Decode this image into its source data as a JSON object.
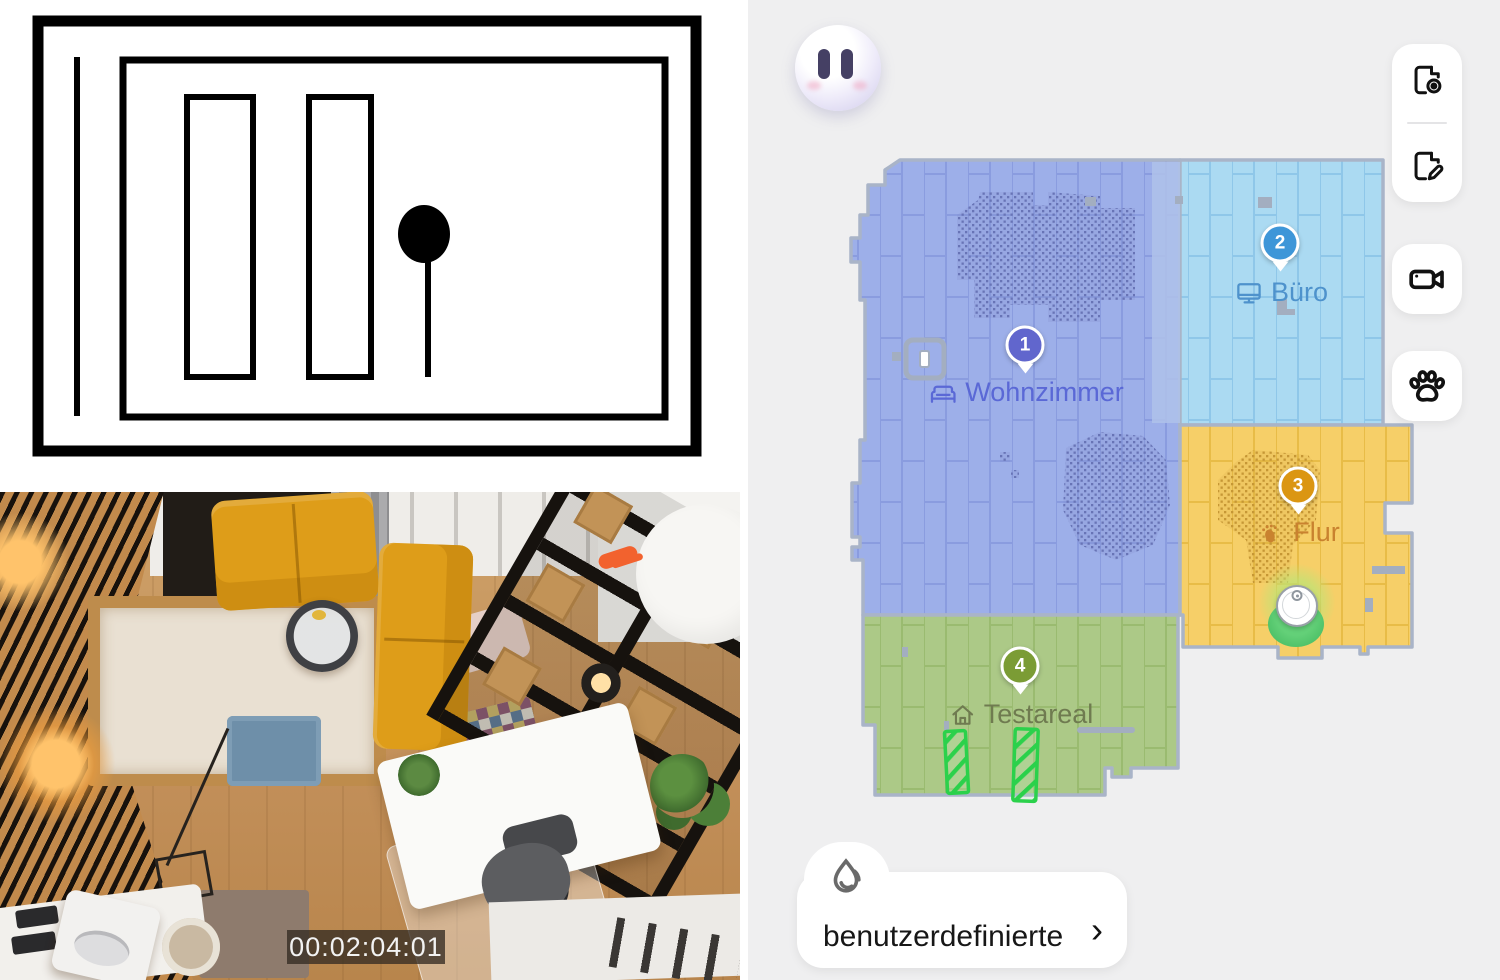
{
  "app": {
    "avatar": {
      "name": "robot-avatar",
      "state": "paused-eyes"
    },
    "toolbar": {
      "buttons": [
        {
          "name": "map-view-toggle",
          "icon": "map-eye-icon"
        },
        {
          "name": "map-edit",
          "icon": "map-edit-icon"
        },
        {
          "name": "video-camera",
          "icon": "camera-icon"
        },
        {
          "name": "pet-mode",
          "icon": "paw-icon"
        }
      ]
    },
    "map": {
      "wall_color": "#A9B4C8",
      "background": "#EFEFF0",
      "rooms": [
        {
          "number": "1",
          "name": "Wohnzimmer",
          "icon": "sofa-icon",
          "fill": "#9DAFE9",
          "marker_color": "#6166CD",
          "label_color": "#5A68D6"
        },
        {
          "number": "2",
          "name": "Büro",
          "icon": "monitor-icon",
          "fill": "#ABDAF2",
          "marker_color": "#3E96D8",
          "label_color": "#4E92CC"
        },
        {
          "number": "3",
          "name": "Flur",
          "icon": "footprints-icon",
          "fill": "#F6CF68",
          "marker_color": "#DB9612",
          "label_color": "#C9822F"
        },
        {
          "number": "4",
          "name": "Testareal",
          "icon": "house-icon",
          "fill": "#ACC987",
          "marker_color": "#7B9C35",
          "label_color": "#6F7B50"
        }
      ],
      "no_go_zone_color": "#2BD14B",
      "robot": {
        "name": "robot-position",
        "on_dock": true
      }
    },
    "bottom_card": {
      "label": "benutzerdefinierte",
      "chevron_glyph": "›",
      "icon": "water-drop-icon"
    }
  },
  "camera_view": {
    "timecode": "00:02:04:01"
  }
}
